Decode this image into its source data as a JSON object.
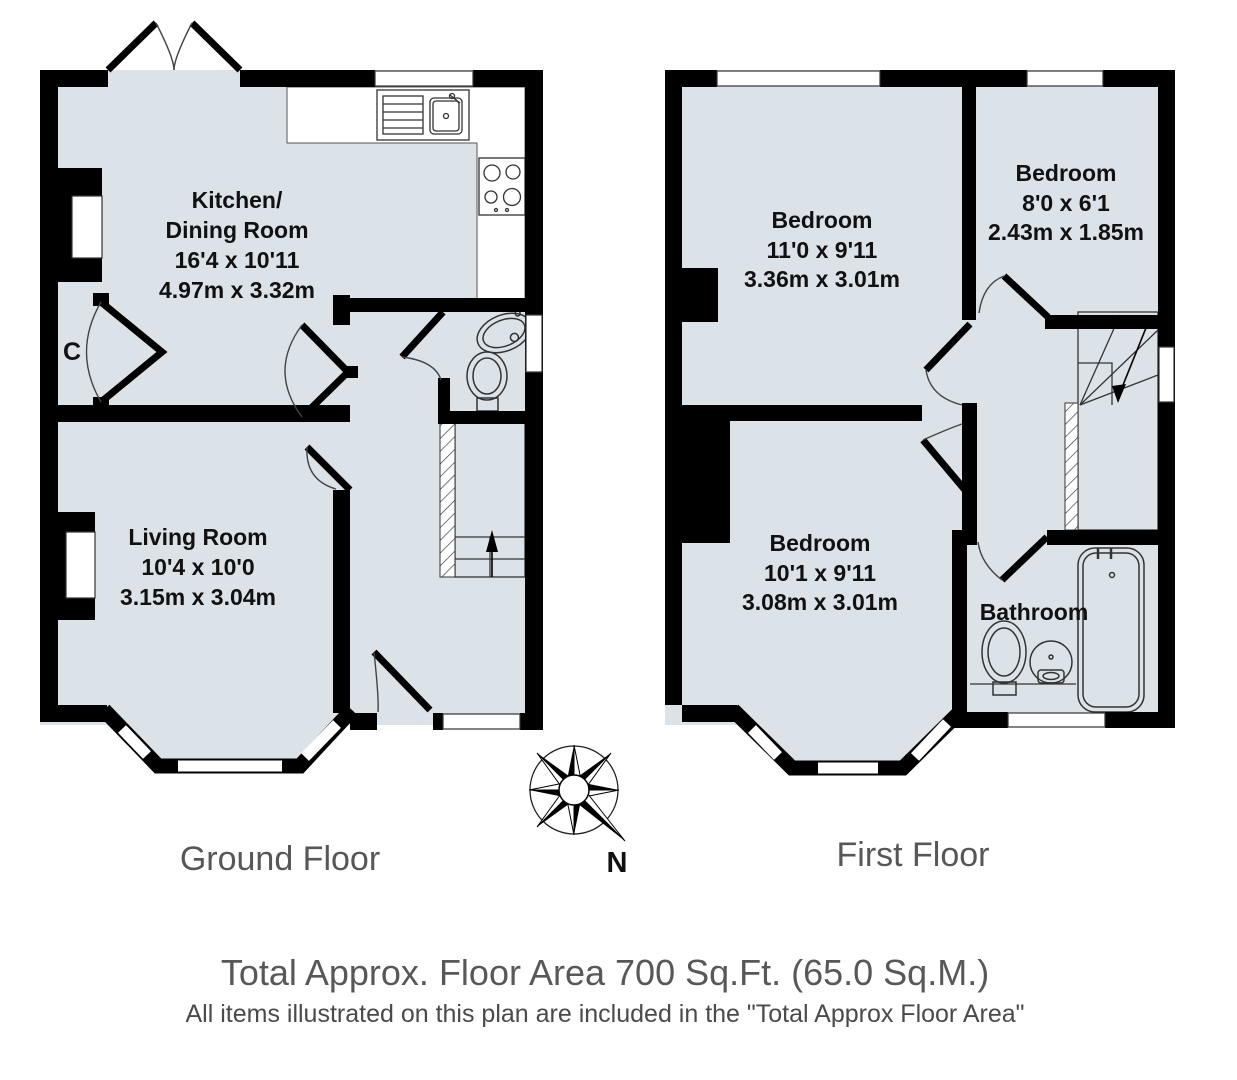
{
  "colors": {
    "room_fill": "#dce3e8",
    "wall": "#000000",
    "label_gray": "#575757",
    "text_black": "#111111"
  },
  "ground_floor": {
    "label": "Ground Floor",
    "rooms": {
      "kitchen_dining": {
        "name_line1": "Kitchen/",
        "name_line2": "Dining Room",
        "size_imperial": "16'4 x 10'11",
        "size_metric": "4.97m x 3.32m"
      },
      "living": {
        "name": "Living Room",
        "size_imperial": "10'4 x 10'0",
        "size_metric": "3.15m x 3.04m"
      },
      "cupboard": {
        "label": "C"
      }
    }
  },
  "first_floor": {
    "label": "First Floor",
    "rooms": {
      "bedroom_1": {
        "name": "Bedroom",
        "size_imperial": "11'0 x 9'11",
        "size_metric": "3.36m x 3.01m"
      },
      "bedroom_2": {
        "name": "Bedroom",
        "size_imperial": "8'0 x 6'1",
        "size_metric": "2.43m x 1.85m"
      },
      "bedroom_3": {
        "name": "Bedroom",
        "size_imperial": "10'1 x 9'11",
        "size_metric": "3.08m x 3.01m"
      },
      "bathroom": {
        "name": "Bathroom"
      }
    }
  },
  "compass": {
    "north_label": "N"
  },
  "footer": {
    "line1": "Total Approx. Floor Area 700 Sq.Ft. (65.0 Sq.M.)",
    "line2": "All items illustrated on this plan are included in the \"Total Approx Floor Area\""
  }
}
